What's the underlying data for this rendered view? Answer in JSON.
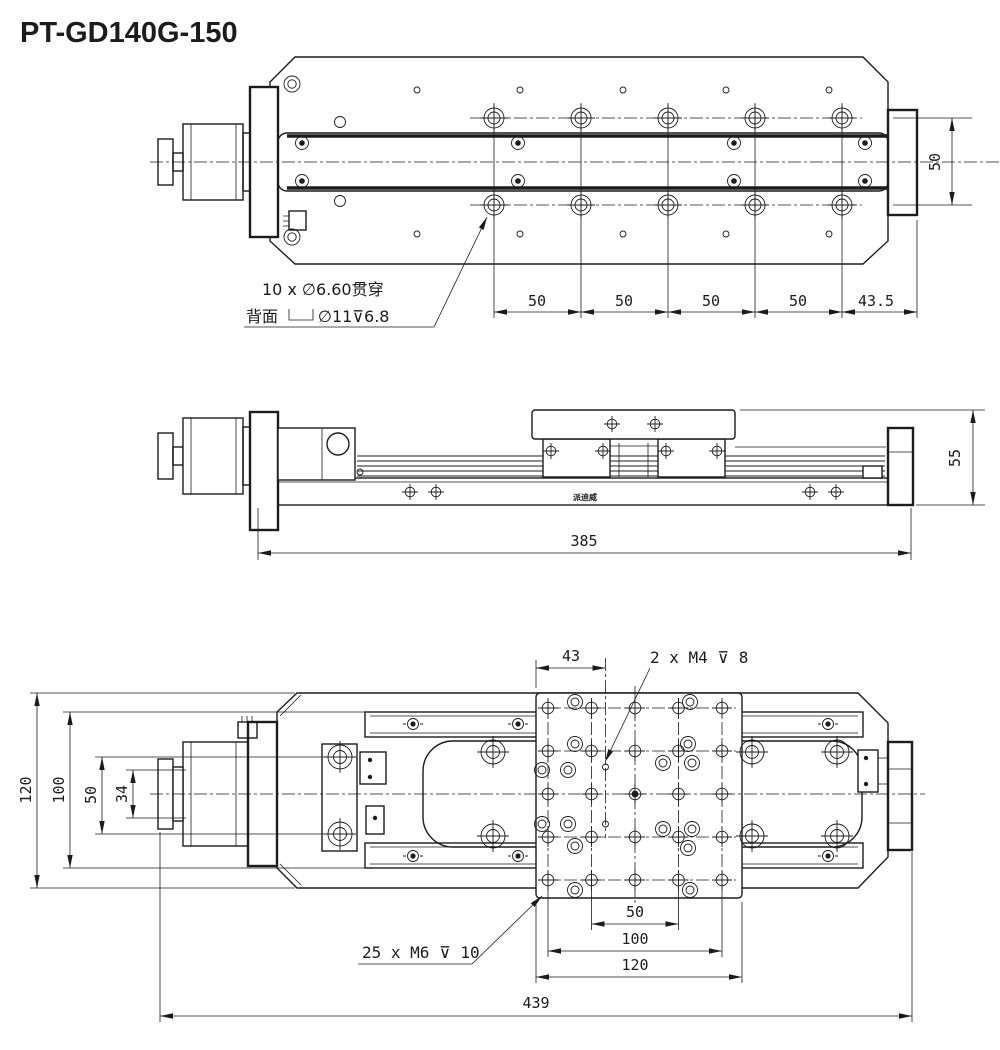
{
  "title": "PT-GD140G-150",
  "top_view": {
    "note_line1": "10 x ∅6.60贯穿",
    "note_prefix": "背面",
    "note_suffix": "∅11⊽6.8",
    "dim_pitch_1": "50",
    "dim_pitch_2": "50",
    "dim_pitch_3": "50",
    "dim_pitch_4": "50",
    "dim_end": "43.5",
    "dim_width": "50"
  },
  "side_view": {
    "dim_length": "385",
    "dim_height": "55",
    "brand": "派迪威"
  },
  "bottom_view": {
    "dim_offset": "43",
    "note_m4": "2 x M4 ⊽ 8",
    "note_m6": "25 x M6 ⊽ 10",
    "dim_width": "120",
    "dim_100": "100",
    "dim_50": "50",
    "dim_34": "34",
    "dim_b50": "50",
    "dim_b100": "100",
    "dim_b120": "120",
    "dim_total": "439"
  }
}
